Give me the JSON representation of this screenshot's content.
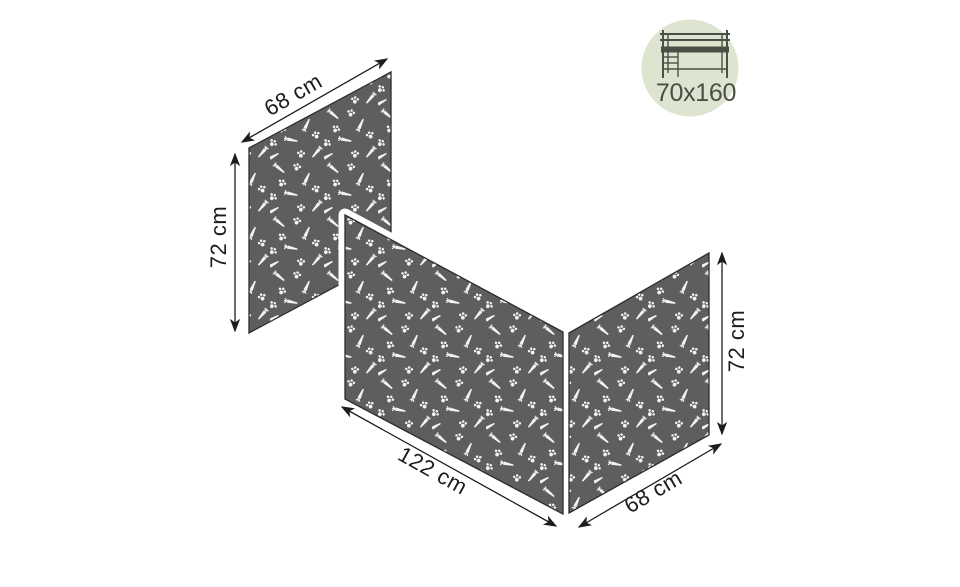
{
  "badge": {
    "icon": "loft-bed-icon",
    "label": "70x160"
  },
  "dimensions": {
    "left_panel_width": "68 cm",
    "left_panel_height": "72 cm",
    "front_panel_width": "122 cm",
    "right_panel_width": "68 cm",
    "right_panel_height": "72 cm"
  },
  "panels": {
    "left": {
      "width": "68 cm",
      "height": "72 cm"
    },
    "front": {
      "width": "122 cm",
      "height": "72 cm"
    },
    "right": {
      "width": "68 cm",
      "height": "72 cm"
    }
  },
  "pattern": {
    "motifs": [
      "carrot",
      "paw-print"
    ],
    "fabric_color": "#5e5e5e",
    "motif_color": "#f4f4f4"
  },
  "colors": {
    "background": "#ffffff",
    "dimension_line": "#1d1d1d",
    "panel_edge": "#2c2c2c",
    "badge_background": "#dde4cf",
    "badge_foreground": "#4b5046"
  }
}
